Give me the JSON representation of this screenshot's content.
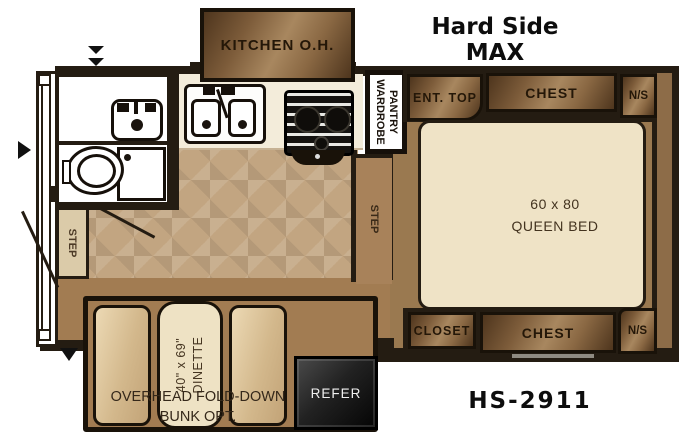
{
  "title": "Hard Side MAX",
  "model": "HS-2911",
  "labels": {
    "kitchen_oh": "KITCHEN O.H.",
    "wardrobe_line1": "WARDROBE",
    "wardrobe_line2": "PANTRY",
    "ent_top": "ENT. TOP",
    "chest_top": "CHEST",
    "ns_top": "N/S",
    "bed_size": "60 x 80",
    "bed_type": "QUEEN BED",
    "closet": "CLOSET",
    "chest_bottom": "CHEST",
    "ns_bottom": "N/S",
    "step_bathroom": "STEP",
    "step_bedroom": "STEP",
    "dinette_size": "40\" x 69\"",
    "dinette": "DINETTE",
    "bunk_line1": "OVERHEAD FOLD-DOWN",
    "bunk_line2": "BUNK OPT.",
    "refer": "REFER"
  },
  "colors": {
    "wall": "#241c12",
    "bronze_highlight": "#a8875f",
    "bronze_shadow": "#4e351d",
    "tile_floor": "#c2a581",
    "bedroom_floor": "#9a7950",
    "slideout_floor": "#a27c52",
    "bed_mattress": "#efe3c6",
    "counter": "#f3ecda",
    "bench": "#dcc69e",
    "step_tan": "#dbcba9",
    "step_brown": "#a8825a",
    "refrigerator": "#1a1a1a",
    "title_text": "#0d0d0d",
    "label_text": "#241708"
  }
}
